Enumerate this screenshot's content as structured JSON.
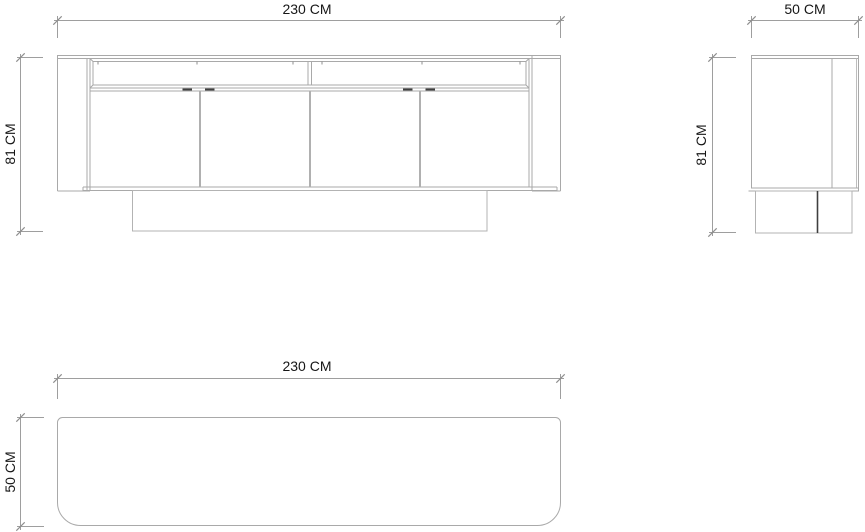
{
  "views": {
    "front": {
      "width_label": "230 CM",
      "height_label": "81 CM"
    },
    "side": {
      "depth_label": "50 CM",
      "height_label": "81 CM"
    },
    "top": {
      "width_label": "230 CM",
      "depth_label": "50 CM"
    }
  },
  "dimensions_cm": {
    "width": 230,
    "height": 81,
    "depth": 50
  },
  "colors": {
    "background": "#ffffff",
    "line": "#a9a9a9",
    "line_light": "#bdbdbd",
    "line_dim": "#9e9e9e",
    "tick": "#8f8f8f",
    "accent_dark": "#3f3f3f",
    "text": "#161616"
  }
}
